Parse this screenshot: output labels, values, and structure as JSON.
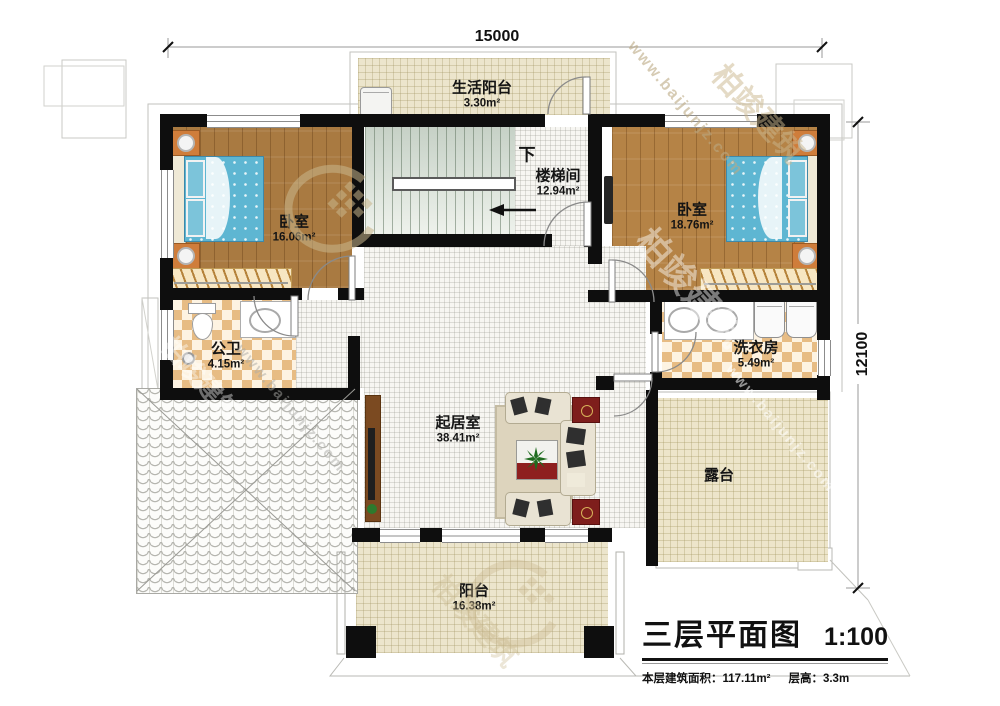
{
  "plan": {
    "title": "三层平面图",
    "scale": "1:100",
    "footer": {
      "floor_area_label": "本层建筑面积：",
      "floor_area_value": "117.11m²",
      "floor_height_label": "层高：",
      "floor_height_value": "3.3m"
    },
    "dimensions": {
      "width": "15000",
      "height": "12100"
    },
    "rooms": [
      {
        "id": "life-balcony",
        "name": "生活阳台",
        "area": "3.30m²"
      },
      {
        "id": "stairwell",
        "name": "楼梯间",
        "area": "12.94m²",
        "direction_label": "下"
      },
      {
        "id": "bedroom-left",
        "name": "卧室",
        "area": "16.06m²"
      },
      {
        "id": "bedroom-right",
        "name": "卧室",
        "area": "18.76m²"
      },
      {
        "id": "bathroom",
        "name": "公卫",
        "area": "4.15m²"
      },
      {
        "id": "laundry",
        "name": "洗衣房",
        "area": "5.49m²"
      },
      {
        "id": "living-room",
        "name": "起居室",
        "area": "38.41m²"
      },
      {
        "id": "terrace",
        "name": "露台",
        "area": ""
      },
      {
        "id": "balcony",
        "name": "阳台",
        "area": "16.38m²"
      }
    ],
    "watermark": {
      "url_text": "www.baijunjz.com",
      "brand_text": "柏竣建筑"
    }
  }
}
